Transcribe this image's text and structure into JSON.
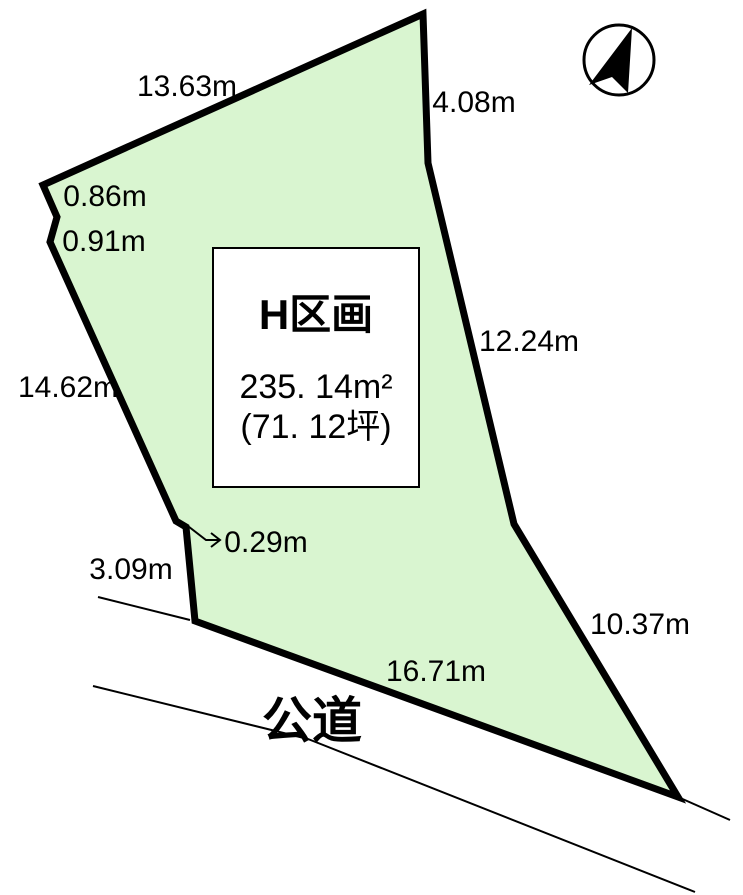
{
  "diagram": {
    "plot": {
      "title": "H区画",
      "area_sqm": "235. 14m²",
      "area_tsubo": "(71. 12坪)"
    },
    "dimensions": {
      "top_edge": "13.63m",
      "upper_right_edge": "4.08m",
      "right_edge": "12.24m",
      "lower_right_edge": "10.37m",
      "bottom_edge": "16.71m",
      "left_edge": "14.62m",
      "left_notch_upper": "0.86m",
      "left_notch_lower": "0.91m",
      "step_width": "0.29m",
      "lower_left_edge": "3.09m"
    },
    "road_label": "公道",
    "icons": {
      "compass": "north-arrow-icon"
    },
    "colors": {
      "plot_fill": "#d9f5d0",
      "line": "#000000",
      "background": "#ffffff"
    }
  }
}
